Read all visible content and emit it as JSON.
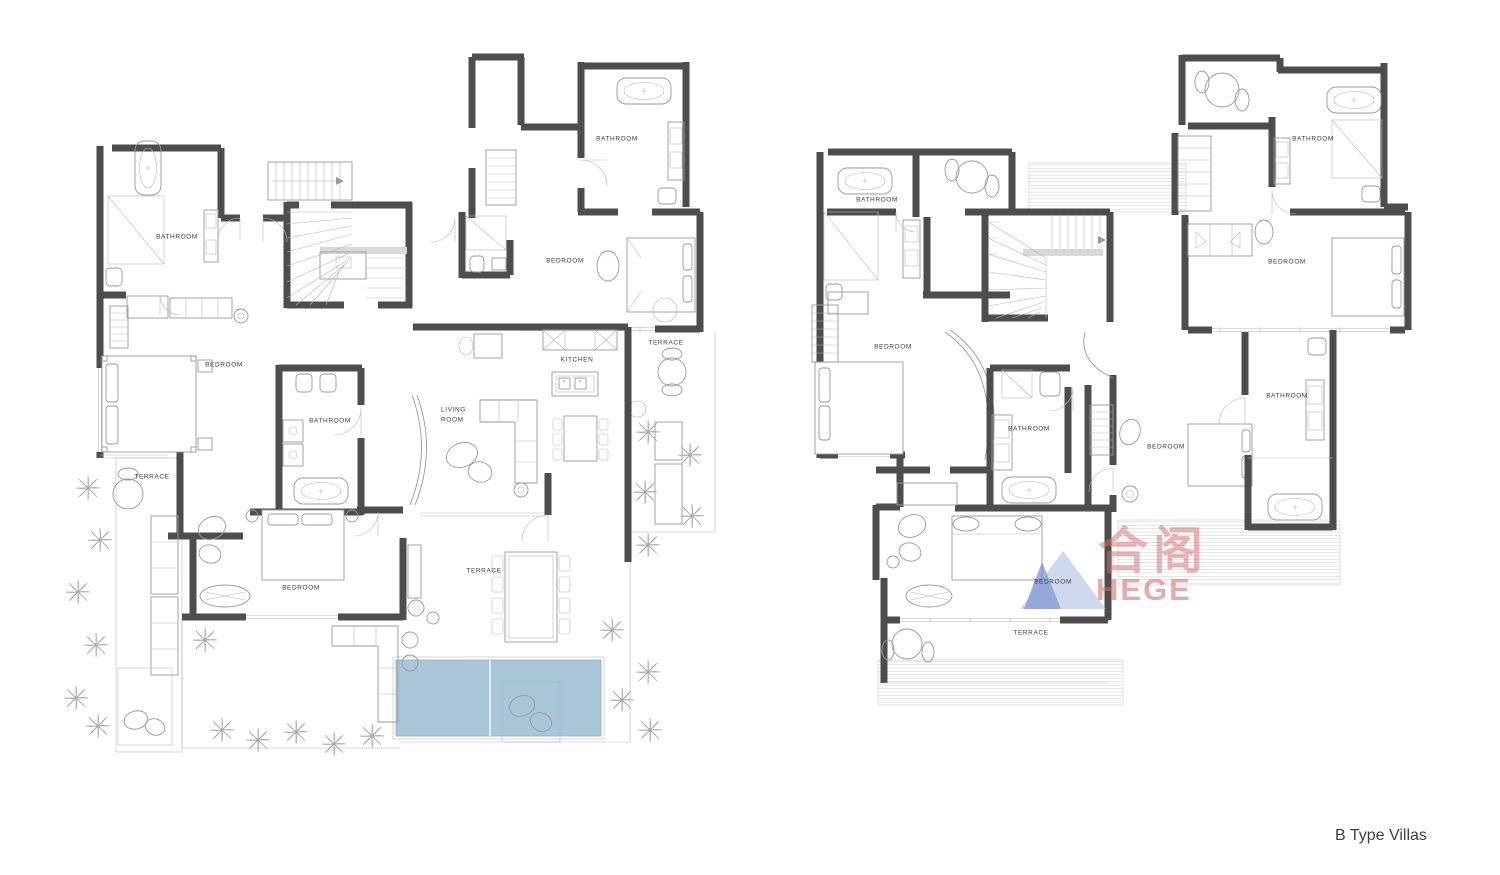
{
  "title": "B Type Villas",
  "plans": {
    "left": {
      "name": "villa-lower-floor-plan",
      "labels": [
        "BATHROOM",
        "BATHROOM",
        "BEDROOM",
        "TERRACE",
        "KITCHEN",
        "LIVING ROOM",
        "BEDROOM",
        "BATHROOM",
        "TERRACE",
        "BEDROOM",
        "TERRACE"
      ]
    },
    "right": {
      "name": "villa-upper-floor-plan",
      "labels": [
        "BATHROOM",
        "BEDROOM",
        "BATHROOM",
        "BEDROOM",
        "BATHROOM",
        "BEDROOM",
        "BATHROOM",
        "BEDROOM",
        "TERRACE"
      ]
    }
  },
  "watermark": {
    "cjk": "合阁",
    "latin": "HEGE"
  },
  "colors": {
    "wall": "#4d4d4d",
    "furniture_line": "#9a9a9a",
    "pool": "#a9c6d9",
    "deck_line": "#cccccc",
    "watermark_blue_light": "#aebfe0",
    "watermark_blue_dark": "#6d88cc",
    "watermark_red": "#d66a6a",
    "label_text": "#3c3c3c"
  }
}
